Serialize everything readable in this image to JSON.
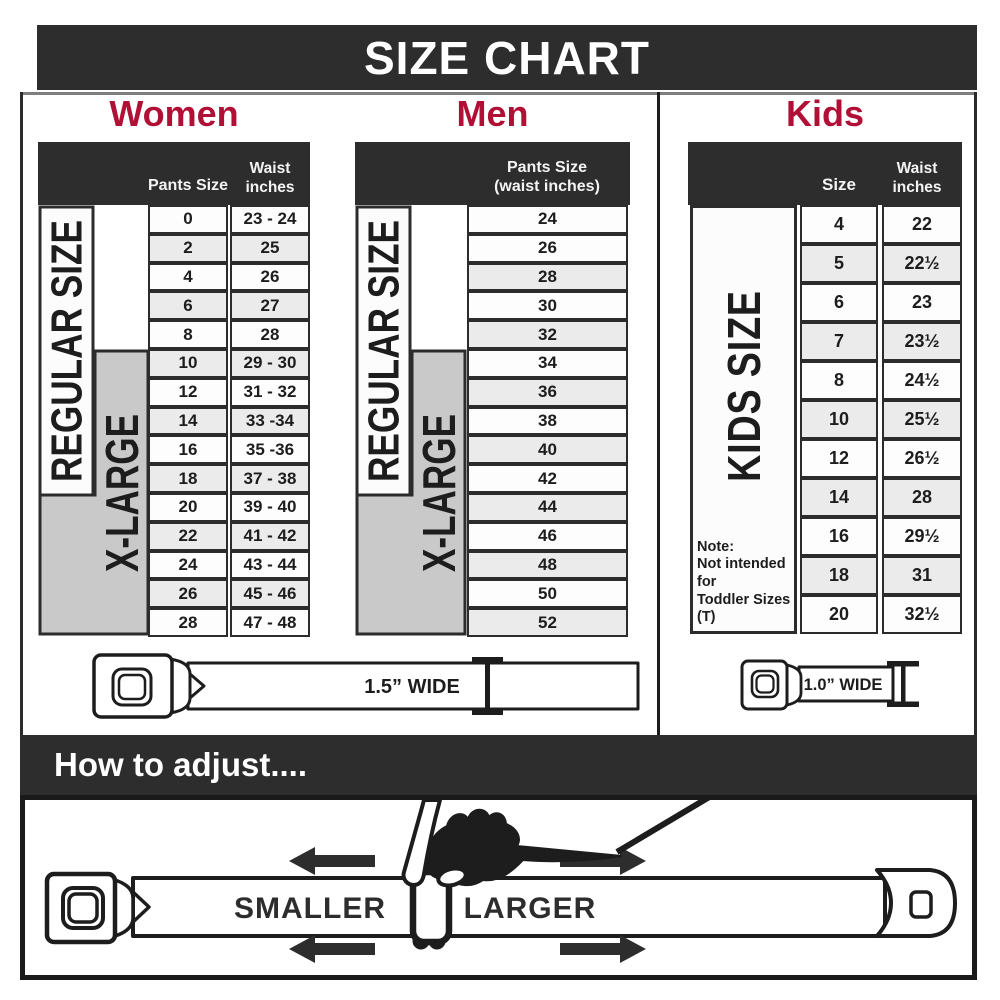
{
  "banner": {
    "title": "SIZE CHART"
  },
  "colors": {
    "accent_red": "#b00f36",
    "dark_gray": "#2d2d2d",
    "row_shade": "#ebebeb",
    "xlarge_gray": "#c9c9c9"
  },
  "women": {
    "title": "Women",
    "headers": {
      "pants": "Pants Size",
      "waist_line1": "Waist",
      "waist_line2": "inches"
    },
    "regular_label": "REGULAR SIZE",
    "xlarge_label": "X-LARGE",
    "rows": [
      {
        "size": "0",
        "waist": "23 - 24"
      },
      {
        "size": "2",
        "waist": "25"
      },
      {
        "size": "4",
        "waist": "26"
      },
      {
        "size": "6",
        "waist": "27"
      },
      {
        "size": "8",
        "waist": "28"
      },
      {
        "size": "10",
        "waist": "29 - 30"
      },
      {
        "size": "12",
        "waist": "31 - 32"
      },
      {
        "size": "14",
        "waist": "33 -34"
      },
      {
        "size": "16",
        "waist": "35 -36"
      },
      {
        "size": "18",
        "waist": "37 - 38"
      },
      {
        "size": "20",
        "waist": "39 - 40"
      },
      {
        "size": "22",
        "waist": "41 - 42"
      },
      {
        "size": "24",
        "waist": "43 - 44"
      },
      {
        "size": "26",
        "waist": "45 - 46"
      },
      {
        "size": "28",
        "waist": "47 - 48"
      }
    ]
  },
  "men": {
    "title": "Men",
    "headers": {
      "line1": "Pants Size",
      "line2": "(waist inches)"
    },
    "regular_label": "REGULAR SIZE",
    "xlarge_label": "X-LARGE",
    "rows": [
      "24",
      "26",
      "28",
      "30",
      "32",
      "34",
      "36",
      "38",
      "40",
      "42",
      "44",
      "46",
      "48",
      "50",
      "52"
    ]
  },
  "kids": {
    "title": "Kids",
    "headers": {
      "size": "Size",
      "waist_line1": "Waist",
      "waist_line2": "inches"
    },
    "side_label": "KIDS SIZE",
    "note": {
      "line1": "Note:",
      "line2": "Not intended for",
      "line3": "Toddler Sizes (T)"
    },
    "rows": [
      {
        "size": "4",
        "waist": "22"
      },
      {
        "size": "5",
        "waist": "22½"
      },
      {
        "size": "6",
        "waist": "23"
      },
      {
        "size": "7",
        "waist": "23½"
      },
      {
        "size": "8",
        "waist": "24½"
      },
      {
        "size": "10",
        "waist": "25½"
      },
      {
        "size": "12",
        "waist": "26½"
      },
      {
        "size": "14",
        "waist": "28"
      },
      {
        "size": "16",
        "waist": "29½"
      },
      {
        "size": "18",
        "waist": "31"
      },
      {
        "size": "20",
        "waist": "32½"
      }
    ]
  },
  "belts": {
    "adult_width": "1.5” WIDE",
    "kids_width": "1.0” WIDE"
  },
  "adjust": {
    "heading": "How to adjust....",
    "smaller": "SMALLER",
    "larger": "LARGER"
  },
  "chart_data": [
    {
      "type": "table",
      "title": "Women",
      "columns": [
        "Pants Size",
        "Waist inches"
      ],
      "rows": [
        [
          "0",
          "23 - 24"
        ],
        [
          "2",
          "25"
        ],
        [
          "4",
          "26"
        ],
        [
          "6",
          "27"
        ],
        [
          "8",
          "28"
        ],
        [
          "10",
          "29 - 30"
        ],
        [
          "12",
          "31 - 32"
        ],
        [
          "14",
          "33 -34"
        ],
        [
          "16",
          "35 -36"
        ],
        [
          "18",
          "37 - 38"
        ],
        [
          "20",
          "39 - 40"
        ],
        [
          "22",
          "41 - 42"
        ],
        [
          "24",
          "43 - 44"
        ],
        [
          "26",
          "45 - 46"
        ],
        [
          "28",
          "47 - 48"
        ]
      ],
      "row_groups": [
        {
          "label": "REGULAR SIZE",
          "from_size": "0",
          "to_size": "18"
        },
        {
          "label": "X-LARGE",
          "from_size": "10",
          "to_size": "28"
        }
      ],
      "belt_width": "1.5” WIDE"
    },
    {
      "type": "table",
      "title": "Men",
      "columns": [
        "Pants Size (waist inches)"
      ],
      "rows": [
        [
          "24"
        ],
        [
          "26"
        ],
        [
          "28"
        ],
        [
          "30"
        ],
        [
          "32"
        ],
        [
          "34"
        ],
        [
          "36"
        ],
        [
          "38"
        ],
        [
          "40"
        ],
        [
          "42"
        ],
        [
          "44"
        ],
        [
          "46"
        ],
        [
          "48"
        ],
        [
          "50"
        ],
        [
          "52"
        ]
      ],
      "row_groups": [
        {
          "label": "REGULAR SIZE",
          "from_size": "24",
          "to_size": "42"
        },
        {
          "label": "X-LARGE",
          "from_size": "34",
          "to_size": "52"
        }
      ],
      "belt_width": "1.5” WIDE"
    },
    {
      "type": "table",
      "title": "Kids",
      "columns": [
        "Size",
        "Waist inches"
      ],
      "rows": [
        [
          "4",
          "22"
        ],
        [
          "5",
          "22½"
        ],
        [
          "6",
          "23"
        ],
        [
          "7",
          "23½"
        ],
        [
          "8",
          "24½"
        ],
        [
          "10",
          "25½"
        ],
        [
          "12",
          "26½"
        ],
        [
          "14",
          "28"
        ],
        [
          "16",
          "29½"
        ],
        [
          "18",
          "31"
        ],
        [
          "20",
          "32½"
        ]
      ],
      "row_groups": [
        {
          "label": "KIDS SIZE",
          "from_size": "4",
          "to_size": "20"
        }
      ],
      "note": "Note: Not intended for Toddler Sizes (T)",
      "belt_width": "1.0” WIDE"
    }
  ]
}
